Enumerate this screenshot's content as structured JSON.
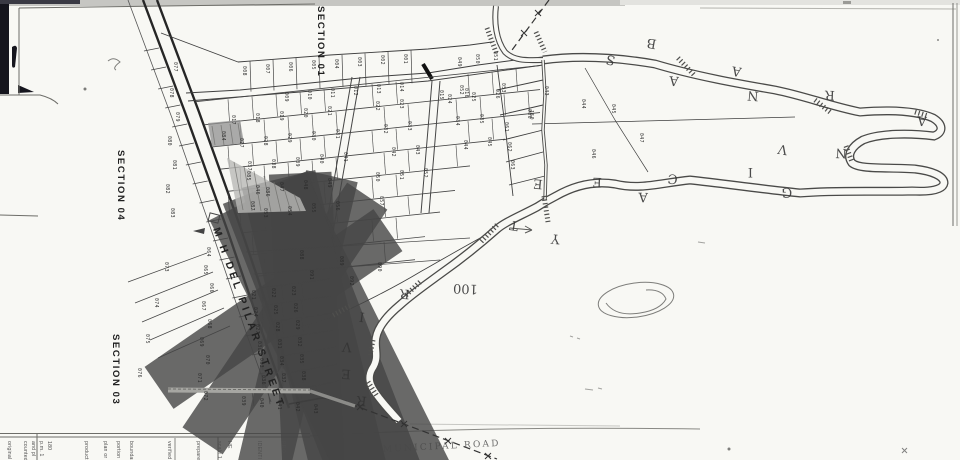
{
  "labels": {
    "sections": [
      {
        "text": "SECTION 01",
        "x": 318,
        "y": 31
      },
      {
        "text": "SECTION 04",
        "x": 118,
        "y": 181
      },
      {
        "text": "SECTION 03",
        "x": 113,
        "y": 366
      }
    ],
    "street": "M H DEL PILAR STREET",
    "road": "MUNICIPAL ROAD",
    "lot_100": "100"
  },
  "scatter_letters": [
    {
      "ch": "S",
      "x": 616,
      "y": 57,
      "r": 195
    },
    {
      "ch": "B",
      "x": 657,
      "y": 40,
      "r": 190
    },
    {
      "ch": "A",
      "x": 679,
      "y": 77,
      "r": 185
    },
    {
      "ch": "A",
      "x": 742,
      "y": 68,
      "r": 190
    },
    {
      "ch": "N",
      "x": 759,
      "y": 92,
      "r": 185
    },
    {
      "ch": "R",
      "x": 835,
      "y": 91,
      "r": 182
    },
    {
      "ch": "A",
      "x": 927,
      "y": 117,
      "r": 185
    },
    {
      "ch": "V",
      "x": 788,
      "y": 146,
      "r": 190
    },
    {
      "ch": "N",
      "x": 847,
      "y": 149,
      "r": 182
    },
    {
      "ch": "I",
      "x": 753,
      "y": 168,
      "r": 180
    },
    {
      "ch": "C",
      "x": 678,
      "y": 175,
      "r": 185
    },
    {
      "ch": "E",
      "x": 602,
      "y": 178,
      "r": 182
    },
    {
      "ch": "G",
      "x": 792,
      "y": 188,
      "r": 178
    },
    {
      "ch": "A",
      "x": 648,
      "y": 193,
      "r": 182
    },
    {
      "ch": "E",
      "x": 543,
      "y": 180,
      "r": 185
    },
    {
      "ch": "T",
      "x": 519,
      "y": 222,
      "r": 190
    },
    {
      "ch": "Y",
      "x": 560,
      "y": 235,
      "r": 185
    },
    {
      "ch": "R",
      "x": 410,
      "y": 290,
      "r": 185
    },
    {
      "ch": "I",
      "x": 365,
      "y": 313,
      "r": 188
    },
    {
      "ch": "V",
      "x": 352,
      "y": 343,
      "r": 185
    },
    {
      "ch": "E",
      "x": 351,
      "y": 370,
      "r": 183
    },
    {
      "ch": "R",
      "x": 367,
      "y": 397,
      "r": 186
    }
  ],
  "lots": [
    {
      "n": "008",
      "x": 243,
      "y": 66
    },
    {
      "n": "007",
      "x": 266,
      "y": 64
    },
    {
      "n": "006",
      "x": 289,
      "y": 62
    },
    {
      "n": "005",
      "x": 312,
      "y": 60
    },
    {
      "n": "004",
      "x": 335,
      "y": 59
    },
    {
      "n": "003",
      "x": 358,
      "y": 57
    },
    {
      "n": "002",
      "x": 381,
      "y": 55
    },
    {
      "n": "001",
      "x": 404,
      "y": 54
    },
    {
      "n": "049",
      "x": 458,
      "y": 57
    },
    {
      "n": "050",
      "x": 476,
      "y": 54
    },
    {
      "n": "051",
      "x": 494,
      "y": 51
    },
    {
      "n": "052",
      "x": 460,
      "y": 85
    },
    {
      "n": "053",
      "x": 502,
      "y": 83
    },
    {
      "n": "009",
      "x": 285,
      "y": 92
    },
    {
      "n": "010",
      "x": 308,
      "y": 90
    },
    {
      "n": "011",
      "x": 331,
      "y": 88
    },
    {
      "n": "012",
      "x": 354,
      "y": 86
    },
    {
      "n": "013",
      "x": 377,
      "y": 84
    },
    {
      "n": "014",
      "x": 400,
      "y": 82
    },
    {
      "n": "015",
      "x": 440,
      "y": 90
    },
    {
      "n": "016",
      "x": 465,
      "y": 88
    },
    {
      "n": "017",
      "x": 232,
      "y": 115
    },
    {
      "n": "018",
      "x": 256,
      "y": 113
    },
    {
      "n": "019",
      "x": 280,
      "y": 111
    },
    {
      "n": "020",
      "x": 304,
      "y": 108
    },
    {
      "n": "021",
      "x": 328,
      "y": 106
    },
    {
      "n": "022",
      "x": 376,
      "y": 101
    },
    {
      "n": "023",
      "x": 400,
      "y": 99
    },
    {
      "n": "024",
      "x": 448,
      "y": 94
    },
    {
      "n": "025",
      "x": 472,
      "y": 92
    },
    {
      "n": "026",
      "x": 496,
      "y": 89
    },
    {
      "n": "027",
      "x": 240,
      "y": 138
    },
    {
      "n": "028",
      "x": 264,
      "y": 136
    },
    {
      "n": "029",
      "x": 288,
      "y": 133
    },
    {
      "n": "030",
      "x": 312,
      "y": 131
    },
    {
      "n": "031",
      "x": 336,
      "y": 129
    },
    {
      "n": "032",
      "x": 384,
      "y": 124
    },
    {
      "n": "033",
      "x": 408,
      "y": 121
    },
    {
      "n": "034",
      "x": 456,
      "y": 116
    },
    {
      "n": "035",
      "x": 480,
      "y": 114
    },
    {
      "n": "036",
      "x": 528,
      "y": 109
    },
    {
      "n": "037",
      "x": 248,
      "y": 161
    },
    {
      "n": "038",
      "x": 272,
      "y": 159
    },
    {
      "n": "039",
      "x": 296,
      "y": 157
    },
    {
      "n": "040",
      "x": 320,
      "y": 154
    },
    {
      "n": "041",
      "x": 344,
      "y": 152
    },
    {
      "n": "042",
      "x": 392,
      "y": 147
    },
    {
      "n": "043",
      "x": 416,
      "y": 145
    },
    {
      "n": "044",
      "x": 464,
      "y": 140
    },
    {
      "n": "045",
      "x": 488,
      "y": 137
    },
    {
      "n": "046",
      "x": 256,
      "y": 185
    },
    {
      "n": "047",
      "x": 280,
      "y": 182
    },
    {
      "n": "048",
      "x": 304,
      "y": 180
    },
    {
      "n": "049",
      "x": 328,
      "y": 178
    },
    {
      "n": "050",
      "x": 376,
      "y": 172
    },
    {
      "n": "051",
      "x": 400,
      "y": 170
    },
    {
      "n": "052",
      "x": 424,
      "y": 168
    },
    {
      "n": "053",
      "x": 264,
      "y": 208
    },
    {
      "n": "054",
      "x": 288,
      "y": 206
    },
    {
      "n": "055",
      "x": 312,
      "y": 203
    },
    {
      "n": "056",
      "x": 336,
      "y": 201
    },
    {
      "n": "057",
      "x": 380,
      "y": 196
    },
    {
      "n": "061",
      "x": 505,
      "y": 122
    },
    {
      "n": "062",
      "x": 508,
      "y": 142
    },
    {
      "n": "063",
      "x": 511,
      "y": 160
    },
    {
      "n": "150",
      "x": 530,
      "y": 110
    },
    {
      "n": "043",
      "x": 545,
      "y": 86
    },
    {
      "n": "044",
      "x": 582,
      "y": 99
    },
    {
      "n": "045",
      "x": 612,
      "y": 104
    },
    {
      "n": "046",
      "x": 592,
      "y": 149
    },
    {
      "n": "047",
      "x": 640,
      "y": 133
    },
    {
      "n": "021",
      "x": 252,
      "y": 290
    },
    {
      "n": "022",
      "x": 272,
      "y": 288
    },
    {
      "n": "023",
      "x": 292,
      "y": 286
    },
    {
      "n": "024",
      "x": 254,
      "y": 307
    },
    {
      "n": "025",
      "x": 274,
      "y": 305
    },
    {
      "n": "026",
      "x": 294,
      "y": 303
    },
    {
      "n": "027",
      "x": 256,
      "y": 324
    },
    {
      "n": "028",
      "x": 276,
      "y": 322
    },
    {
      "n": "029",
      "x": 296,
      "y": 320
    },
    {
      "n": "030",
      "x": 258,
      "y": 341
    },
    {
      "n": "031",
      "x": 278,
      "y": 339
    },
    {
      "n": "032",
      "x": 298,
      "y": 337
    },
    {
      "n": "033",
      "x": 260,
      "y": 358
    },
    {
      "n": "034",
      "x": 280,
      "y": 356
    },
    {
      "n": "035",
      "x": 300,
      "y": 354
    },
    {
      "n": "036",
      "x": 262,
      "y": 375
    },
    {
      "n": "037",
      "x": 282,
      "y": 373
    },
    {
      "n": "038",
      "x": 302,
      "y": 371
    },
    {
      "n": "039",
      "x": 242,
      "y": 396
    },
    {
      "n": "040",
      "x": 260,
      "y": 398
    },
    {
      "n": "041",
      "x": 278,
      "y": 400
    },
    {
      "n": "042",
      "x": 296,
      "y": 402
    },
    {
      "n": "043",
      "x": 314,
      "y": 404
    },
    {
      "n": "064",
      "x": 207,
      "y": 247
    },
    {
      "n": "065",
      "x": 204,
      "y": 265
    },
    {
      "n": "066",
      "x": 210,
      "y": 283
    },
    {
      "n": "067",
      "x": 202,
      "y": 301
    },
    {
      "n": "068",
      "x": 208,
      "y": 319
    },
    {
      "n": "069",
      "x": 200,
      "y": 337
    },
    {
      "n": "070",
      "x": 206,
      "y": 355
    },
    {
      "n": "071",
      "x": 198,
      "y": 373
    },
    {
      "n": "072",
      "x": 204,
      "y": 391
    },
    {
      "n": "073",
      "x": 165,
      "y": 262
    },
    {
      "n": "074",
      "x": 155,
      "y": 298
    },
    {
      "n": "075",
      "x": 146,
      "y": 334
    },
    {
      "n": "076",
      "x": 138,
      "y": 368
    },
    {
      "n": "077",
      "x": 174,
      "y": 62
    },
    {
      "n": "078",
      "x": 170,
      "y": 88
    },
    {
      "n": "079",
      "x": 176,
      "y": 112
    },
    {
      "n": "080",
      "x": 168,
      "y": 136
    },
    {
      "n": "081",
      "x": 173,
      "y": 160
    },
    {
      "n": "082",
      "x": 166,
      "y": 184
    },
    {
      "n": "083",
      "x": 171,
      "y": 208
    },
    {
      "n": "084",
      "x": 222,
      "y": 131
    },
    {
      "n": "085",
      "x": 247,
      "y": 171
    },
    {
      "n": "086",
      "x": 266,
      "y": 187
    },
    {
      "n": "087",
      "x": 251,
      "y": 201
    },
    {
      "n": "088",
      "x": 300,
      "y": 250
    },
    {
      "n": "089",
      "x": 340,
      "y": 256
    },
    {
      "n": "090",
      "x": 378,
      "y": 262
    },
    {
      "n": "091",
      "x": 310,
      "y": 270
    },
    {
      "n": "092",
      "x": 350,
      "y": 276
    }
  ],
  "notes": [
    {
      "t": "original",
      "x": 8
    },
    {
      "t": "counted",
      "x": 24
    },
    {
      "t": "and pl",
      "x": 32
    },
    {
      "t": "p.m. 1",
      "x": 40
    },
    {
      "t": "180",
      "x": 48
    },
    {
      "t": "products",
      "x": 85
    },
    {
      "t": "plan or being",
      "x": 104
    },
    {
      "t": "portion used",
      "x": 117
    },
    {
      "t": "boundaries",
      "x": 130
    },
    {
      "t": "verified",
      "x": 168
    },
    {
      "t": "prepared",
      "x": 197
    },
    {
      "t": "scale 1",
      "x": 218
    },
    {
      "t": "HE",
      "x": 228
    },
    {
      "t": "IDENTI",
      "x": 258
    },
    {
      "t": "PRO",
      "x": 282
    }
  ],
  "colors": {
    "paper": "#f8f8f4",
    "ink": "#3a3a3a",
    "pencil": "#8f8f8c",
    "dark_edge": "#15151d"
  }
}
